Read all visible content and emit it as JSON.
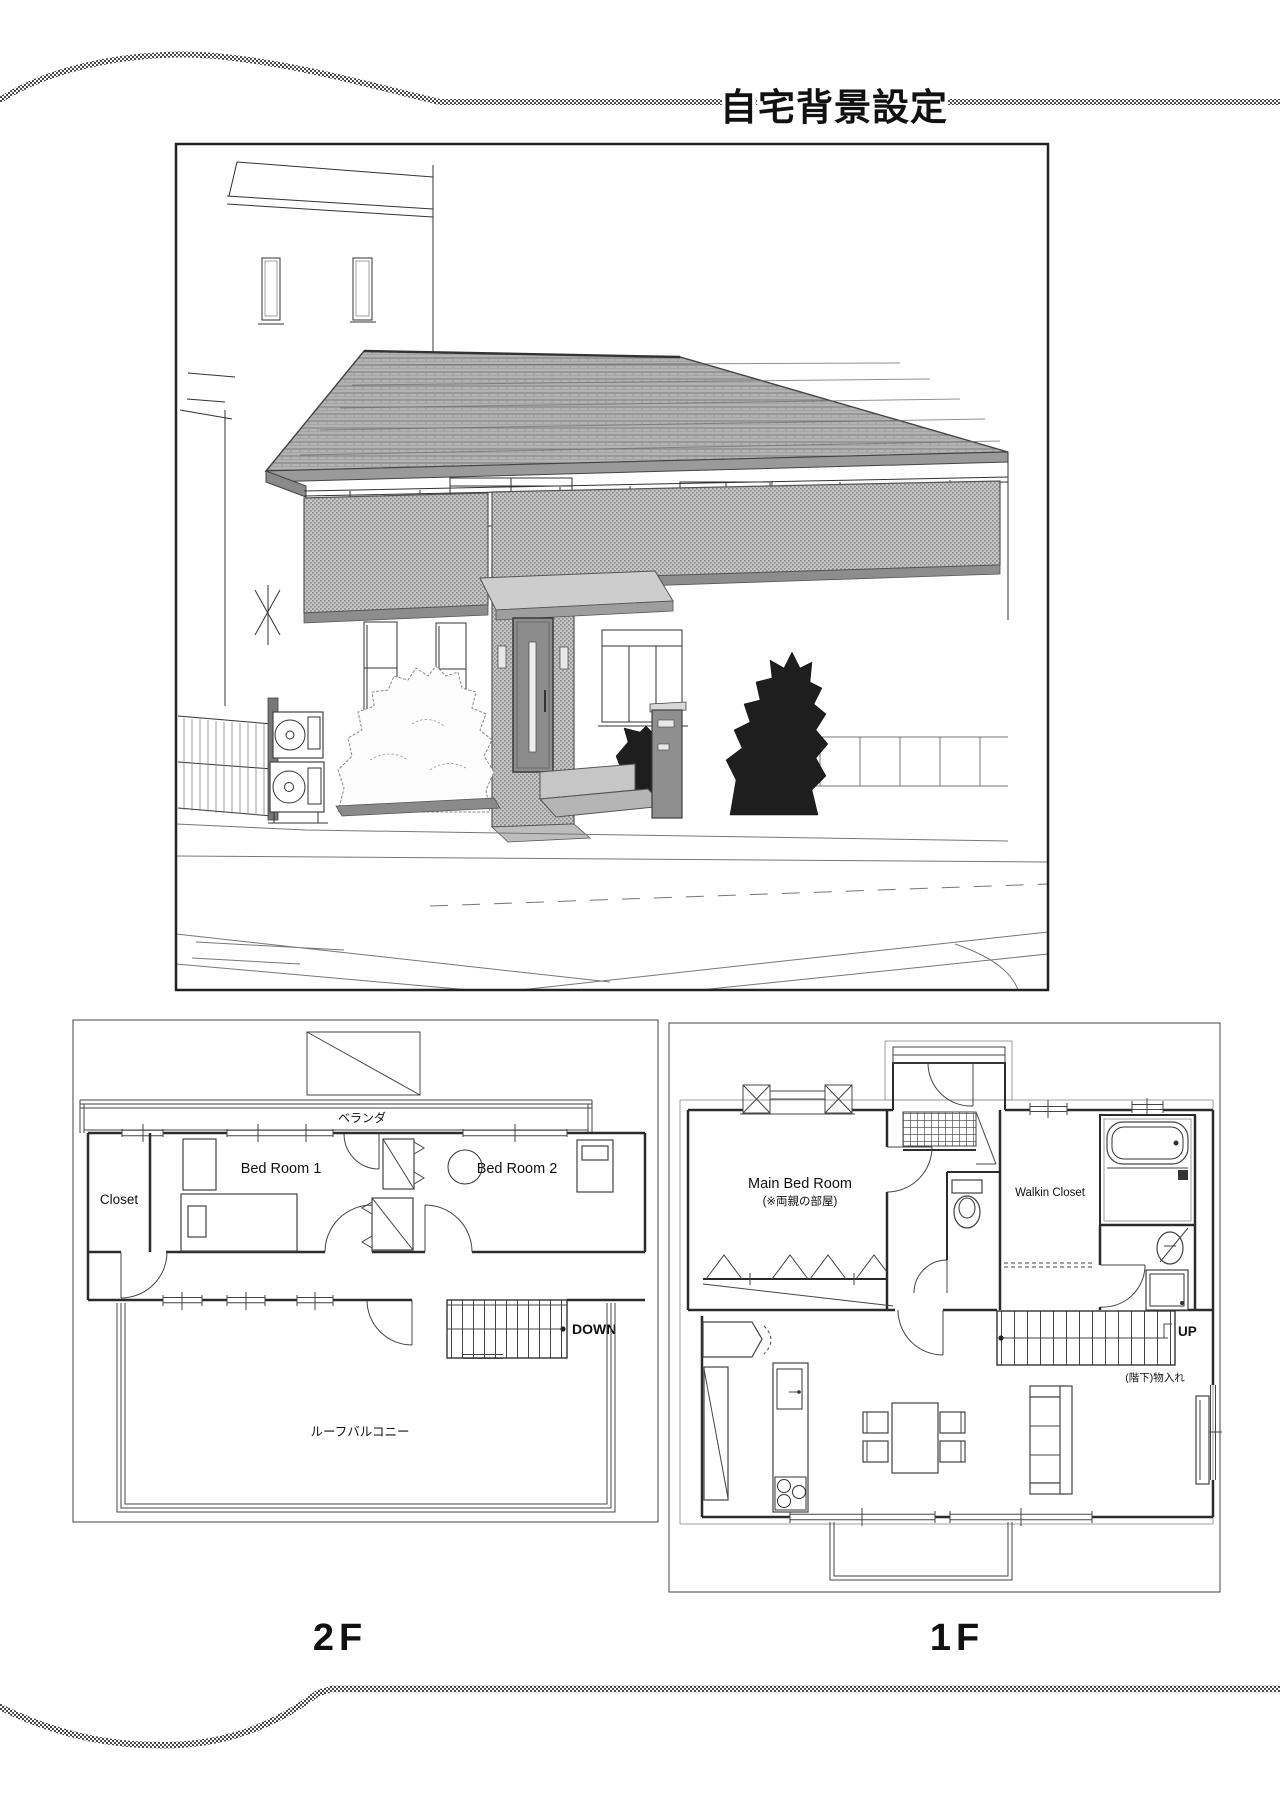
{
  "page": {
    "title": "自宅背景設定",
    "ink_color": "#1a1a1a",
    "paper_color": "#ffffff",
    "screen_tone_color": "#c6c6c6",
    "roof_tone_color": "#b3b3b3"
  },
  "floor_plan_2f": {
    "floor_label": "2F",
    "veranda_label": "ベランダ",
    "closet_label": "Closet",
    "bedroom1_label": "Bed Room 1",
    "bedroom2_label": "Bed Room 2",
    "down_label": "DOWN",
    "roof_balcony_label": "ルーフバルコニー"
  },
  "floor_plan_1f": {
    "floor_label": "1F",
    "main_bedroom_label": "Main Bed Room",
    "main_bedroom_note": "(※両親の部屋)",
    "walkin_closet_label": "Walkin Closet",
    "up_label": "UP",
    "understair_storage_label": "(階下)物入れ"
  }
}
